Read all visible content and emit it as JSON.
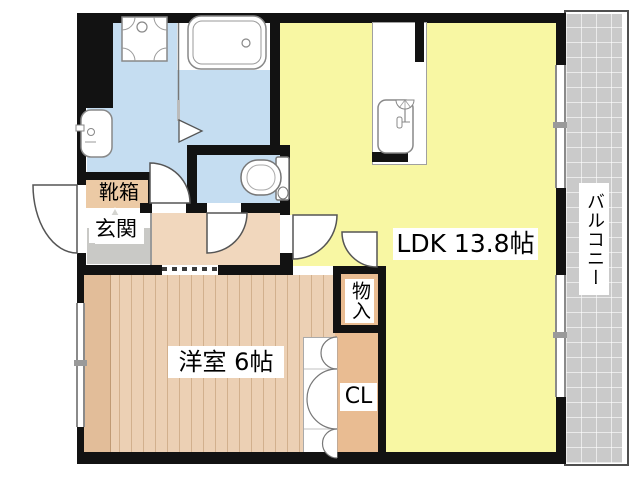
{
  "title": "apartment floor plan",
  "rooms": {
    "ldk": "LDK 13.8帖",
    "western_room": "洋室 6帖",
    "entrance": "玄関",
    "shoe_box": "靴箱",
    "storage": "物入",
    "closet": "CL",
    "balcony": "バルコニー"
  },
  "colors": {
    "ldk_fill": "#f8f7a3",
    "wet_area_fill": "#c5ddf1",
    "hall_fill": "#f1d7bd",
    "shoe_box_fill": "#eccaa5",
    "wood_floor_fill": "#ecd0b4",
    "closet_fill": "#e9bc92",
    "balcony_fill": "#cacaca",
    "tataki_gray": "#c9c9c6",
    "wall": "#121212"
  }
}
